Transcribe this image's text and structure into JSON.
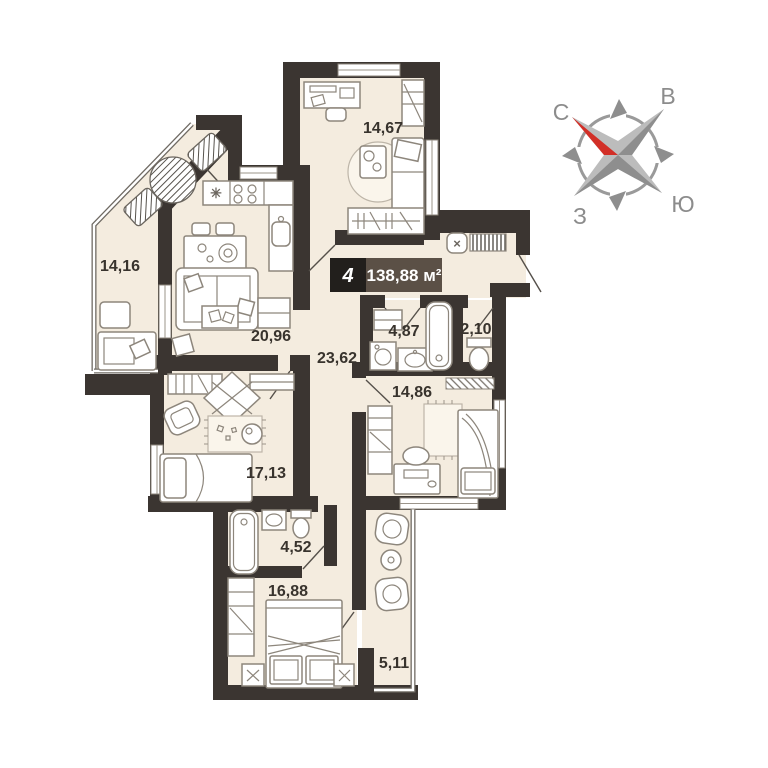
{
  "apartment": {
    "rooms_badge": "4",
    "area_badge": "138,88 м²"
  },
  "rooms": [
    {
      "name": "study",
      "area": "14,67"
    },
    {
      "name": "loggia-top",
      "area": "14,16"
    },
    {
      "name": "living-kitchen",
      "area": "20,96"
    },
    {
      "name": "hall",
      "area": "23,62"
    },
    {
      "name": "bathroom",
      "area": "4,87"
    },
    {
      "name": "wc",
      "area": "2,10"
    },
    {
      "name": "bedroom-middle",
      "area": "14,86"
    },
    {
      "name": "children-room",
      "area": "17,13"
    },
    {
      "name": "bathroom-2",
      "area": "4,52"
    },
    {
      "name": "bedroom-master",
      "area": "16,88"
    },
    {
      "name": "loggia-bottom",
      "area": "5,11"
    }
  ],
  "compass": {
    "north": "С",
    "east": "В",
    "south": "Ю",
    "west": "З"
  },
  "symbols": {
    "entrance_marker": "×",
    "hob": "✳"
  },
  "colors": {
    "wall": "#3b3531",
    "floor": "#f4ecdf",
    "badge_black": "#221f1c",
    "badge_brown": "#5b5046",
    "compass_red": "#d22f27"
  }
}
